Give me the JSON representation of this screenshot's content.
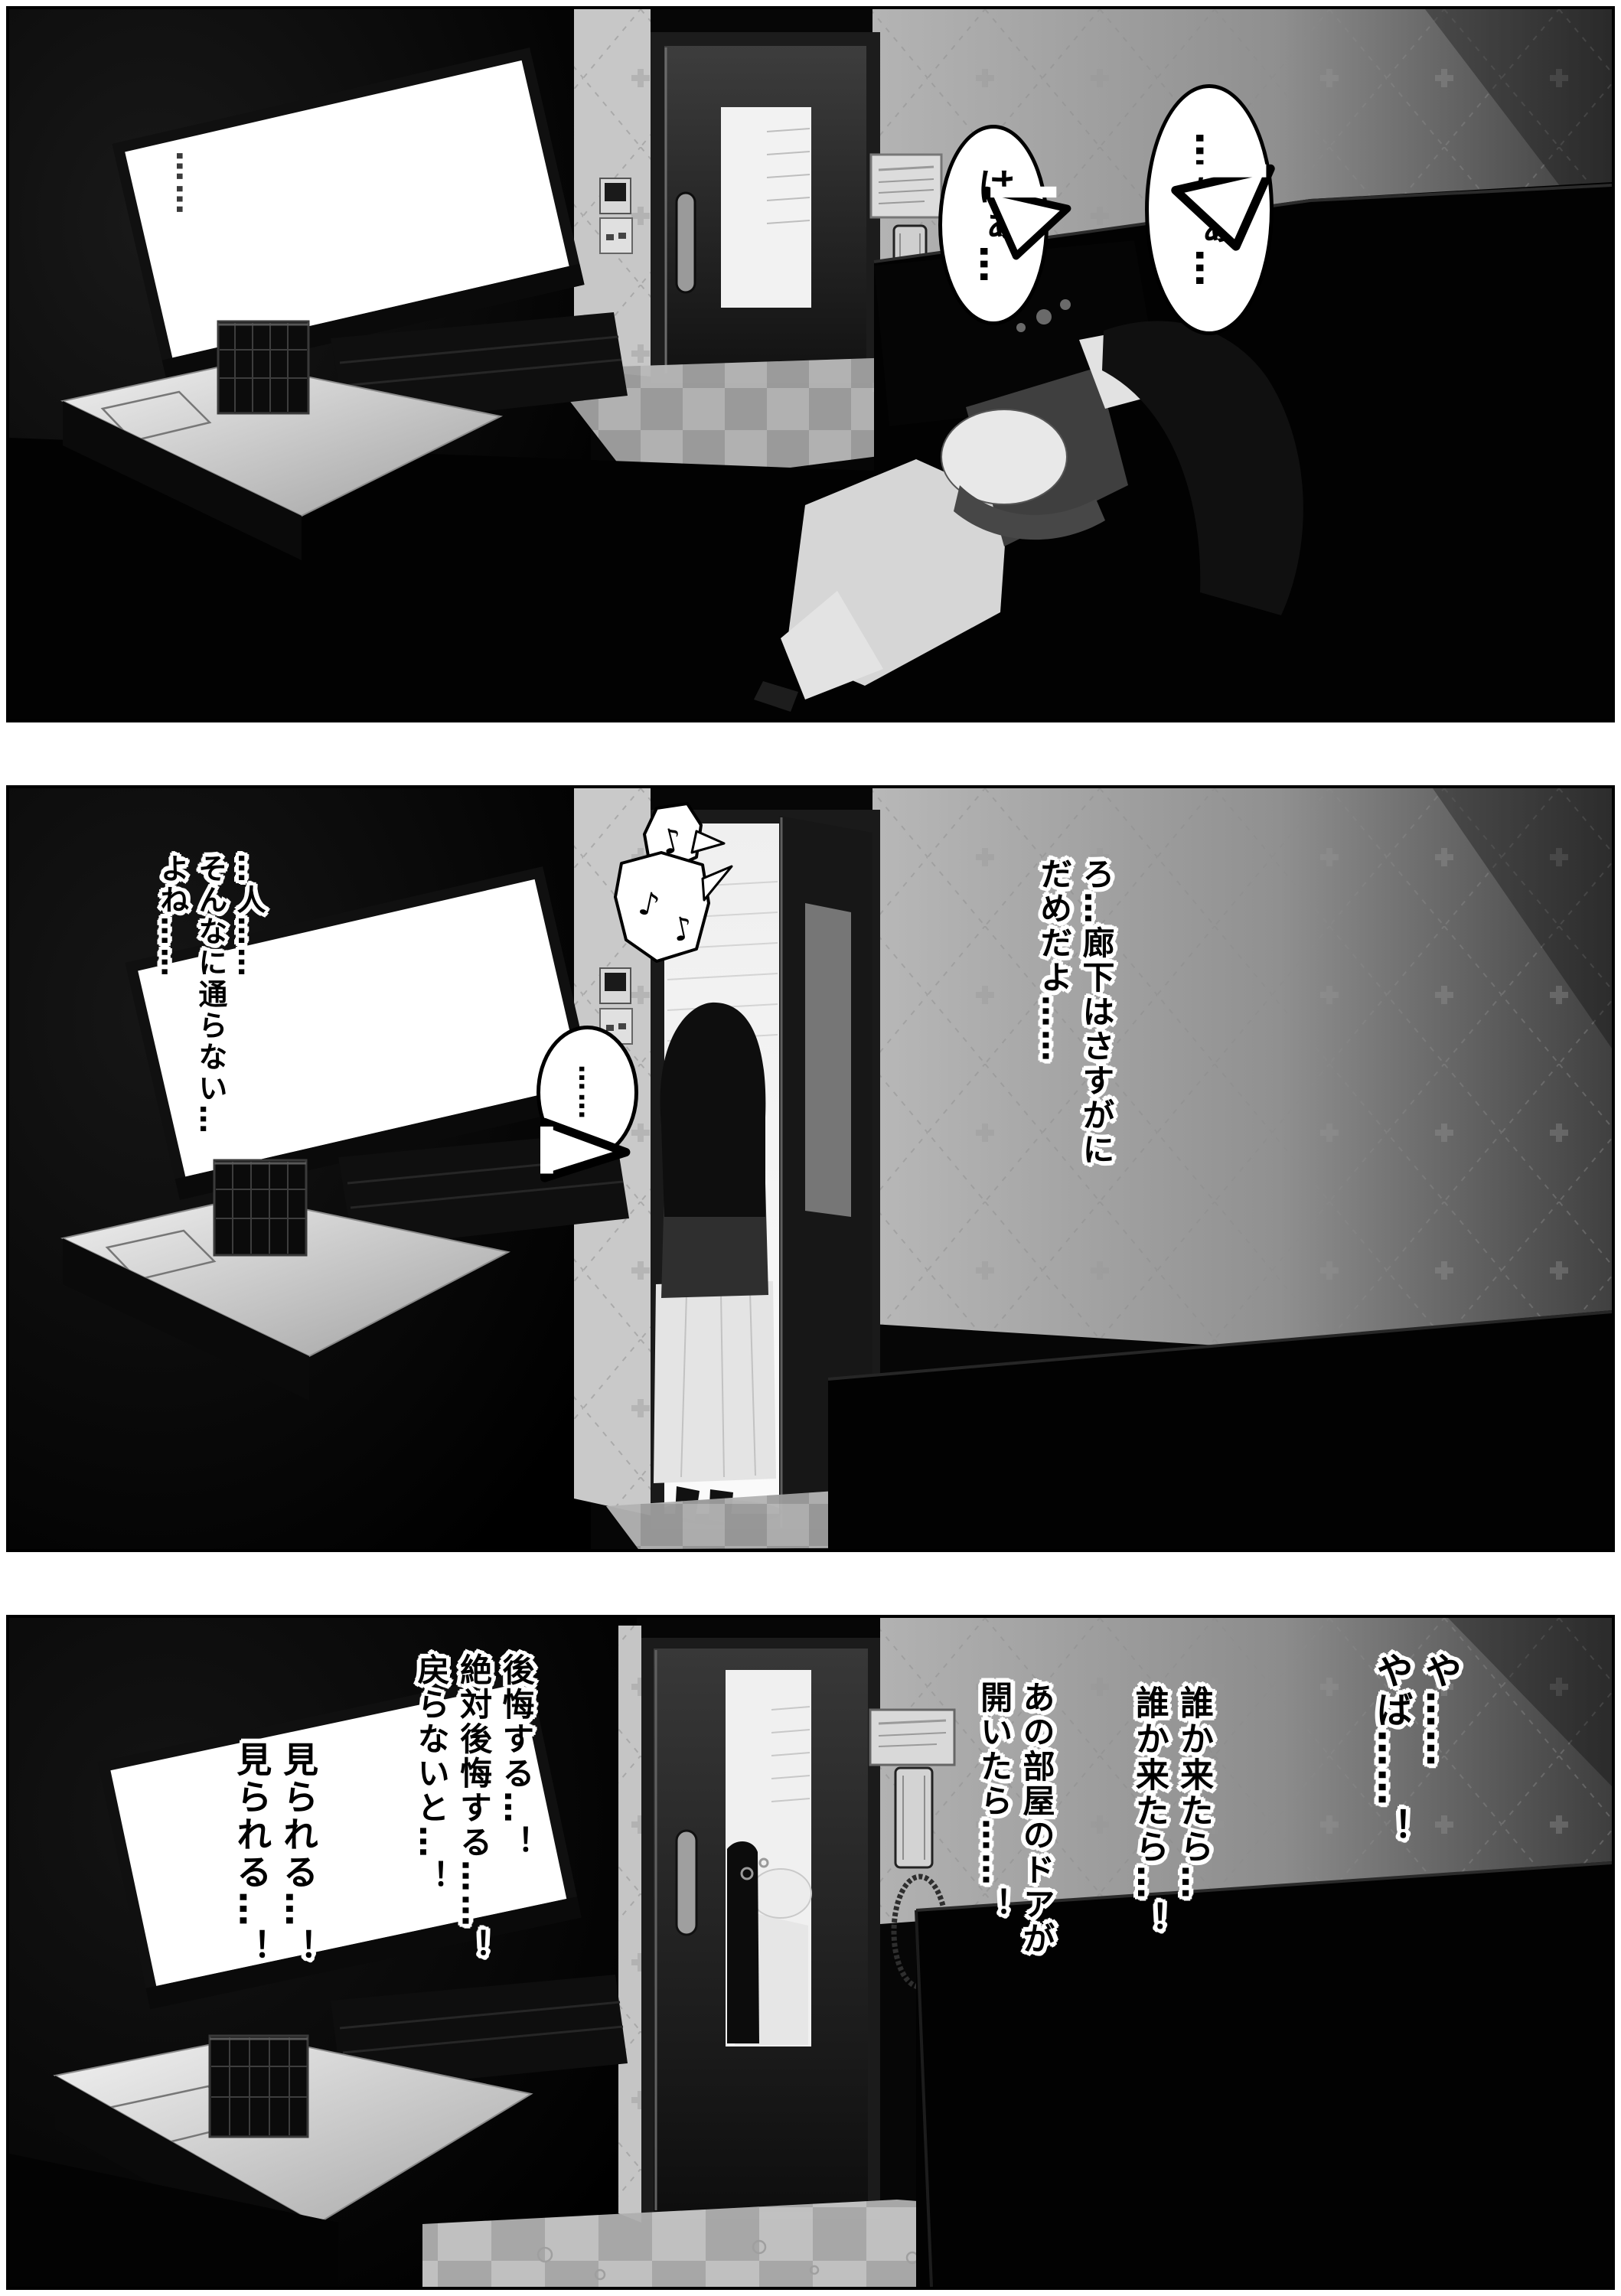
{
  "page": {
    "type": "manga-page",
    "panel_count": 3,
    "background": "#ffffff",
    "panel_border": "#000000"
  },
  "colors": {
    "room_dark": "#060606",
    "wall_light": "#b4b4b4",
    "wall_dark": "#3c3c3c",
    "wallpaper_strip": "#c7c7c7",
    "tv_screen": "#ffffff",
    "door_window": "#f2f2f2",
    "floor_tile_light": "#e3e3e3",
    "floor_tile_dark": "#c6c6c6",
    "text_fill": "#000000",
    "text_outline": "#ffffff"
  },
  "panel1": {
    "ambient_ellipsis": "……",
    "bubbles": {
      "left": "はぁ…",
      "right": "…はぁ…"
    }
  },
  "panel2": {
    "notes": {
      "a": "♪",
      "b": "♪",
      "c": "♪"
    },
    "silence_bubble": "……",
    "monologue_right": "ろ…廊下はさすがに\nだめだよ……",
    "monologue_left": "…人……\nそんなに通らない…\nよね……"
  },
  "panel3": {
    "monologue_far_right": "や……\nやば……！",
    "monologue_right": "誰か来たら…\n誰か来たら…！",
    "monologue_mid": "あの部屋のドアが\n開いたら……！",
    "monologue_left": "後悔する…！\n絶対後悔する……！\n戻らないと…！",
    "monologue_far_left": "見られる…！\n見られる…！"
  }
}
